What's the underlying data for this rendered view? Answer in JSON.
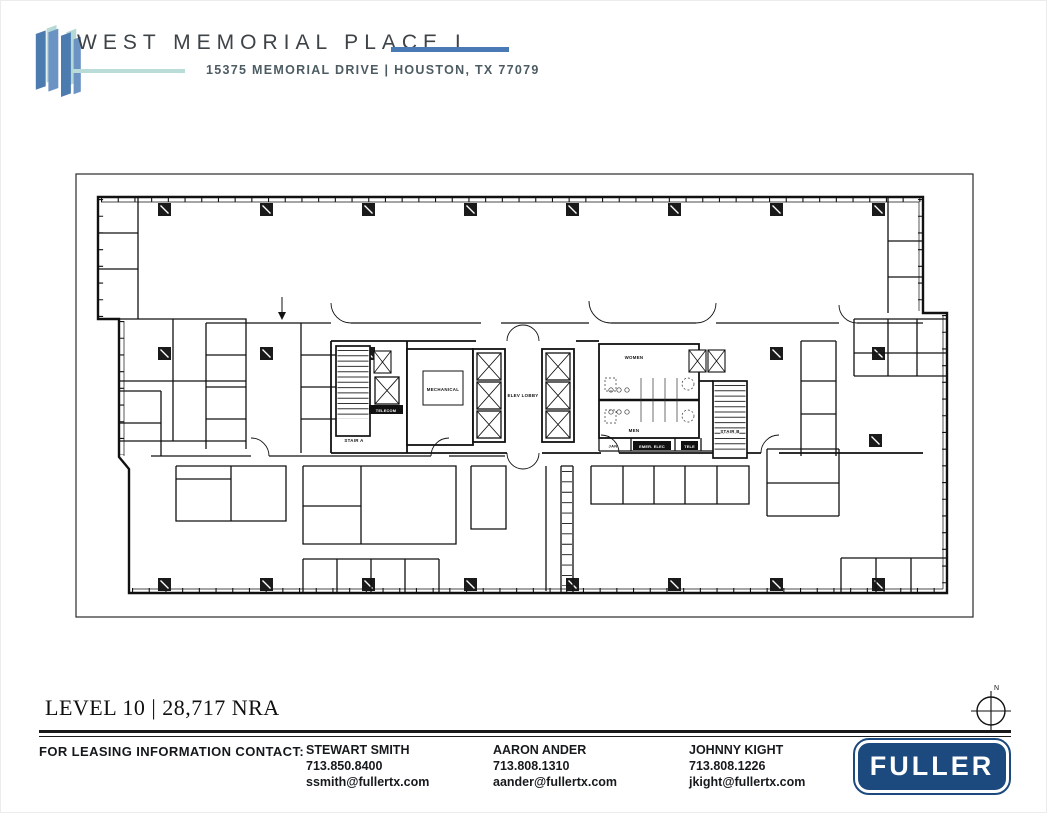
{
  "header": {
    "title": "WEST MEMORIAL PLACE I",
    "address": "15375 MEMORIAL DRIVE | HOUSTON, TX 77079",
    "accent_blue": "#4a7ab5",
    "accent_teal": "#b9dcd8"
  },
  "plan": {
    "level_label": "LEVEL 10 | 28,717 NRA",
    "compass": {
      "north_label": "N"
    },
    "rooms": {
      "mechanical": "MECHANICAL",
      "elev_lobby": "ELEV LOBBY",
      "women": "WOMEN",
      "men": "MEN",
      "stair_a": "STAIR A",
      "stair_b": "STAIR B",
      "telecom": "TELECOM",
      "jan": "JAN",
      "emer_elec": "EMER. ELEC",
      "tele": "TELE"
    }
  },
  "footer": {
    "contact_heading": "FOR LEASING INFORMATION CONTACT:",
    "contacts": [
      {
        "name": "STEWART SMITH",
        "phone": "713.850.8400",
        "email": "ssmith@fullertx.com"
      },
      {
        "name": "AARON ANDER",
        "phone": "713.808.1310",
        "email": "aander@fullertx.com"
      },
      {
        "name": "JOHNNY KIGHT",
        "phone": "713.808.1226",
        "email": "jkight@fullertx.com"
      }
    ],
    "brand": "FULLER",
    "brand_color": "#1c4a7e"
  }
}
